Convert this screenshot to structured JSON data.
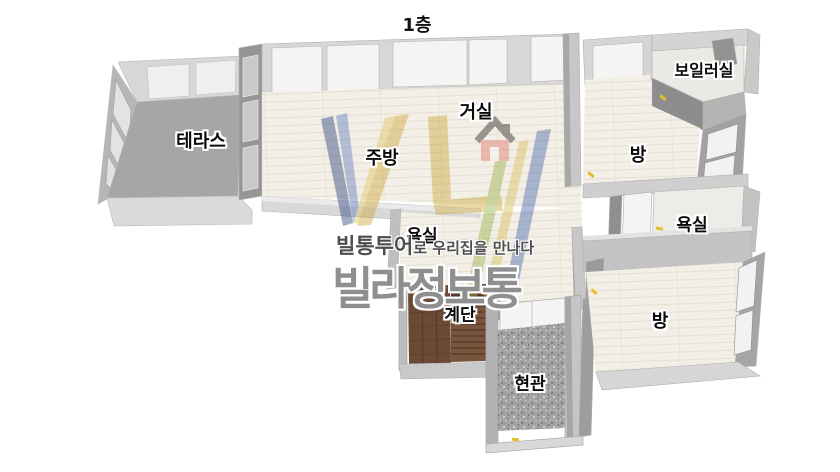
{
  "title": "1층",
  "rooms": [
    {
      "id": "terrace",
      "label": "테라스"
    },
    {
      "id": "kitchen",
      "label": "주방"
    },
    {
      "id": "living-room",
      "label": "거실"
    },
    {
      "id": "boiler-room",
      "label": "보일러실"
    },
    {
      "id": "room-top-right",
      "label": "방"
    },
    {
      "id": "bath-right",
      "label": "욕실"
    },
    {
      "id": "bath-center",
      "label": "욕실"
    },
    {
      "id": "room-bottom-right",
      "label": "방"
    },
    {
      "id": "stairs",
      "label": "계단"
    },
    {
      "id": "entrance",
      "label": "현관"
    }
  ],
  "watermark": {
    "tagline_bold": "빌통투어",
    "tagline_rest": "로 우리집을 만나다",
    "brand": "빌라정보통"
  },
  "colors": {
    "floor_cream": "#f3efe7",
    "wall_light": "#d7d7d7",
    "wall_dark": "#9a9a9a",
    "terrace_floor": "#a6a6a6",
    "stairs_wood": "#6b4934",
    "entrance_tile": "#a3a3a3",
    "door_marker": "#e3bf2c",
    "logo_navy": "#1e3a75",
    "logo_blue": "#3f5fa8",
    "logo_gold": "#c9a22f",
    "logo_red": "#dd6f5e",
    "logo_green": "#93ad3f",
    "watermark_gray": "#8f8f8f"
  }
}
